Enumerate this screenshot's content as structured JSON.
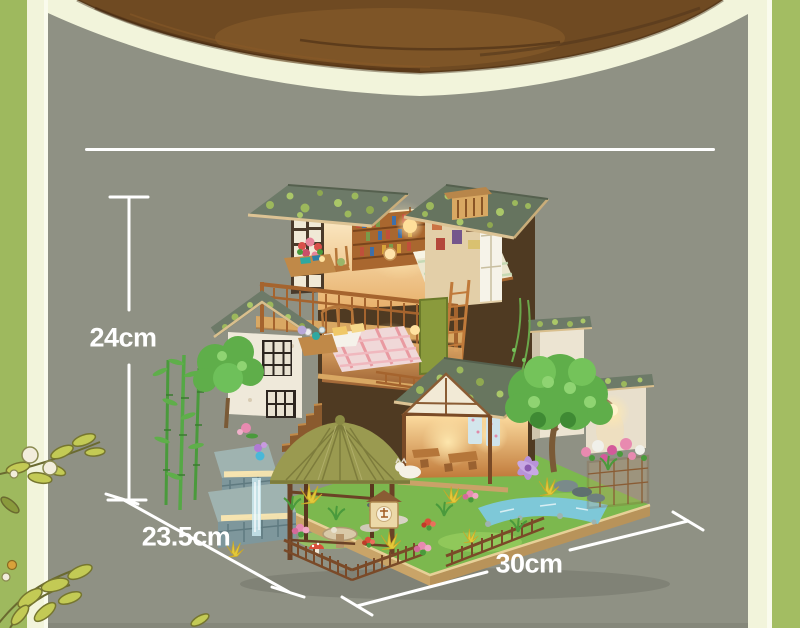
{
  "frame": {
    "left_bar_color": "#9eb95e",
    "right_bar_color": "#a3bd62",
    "mat_color": "#f2f4db",
    "backdrop_color": "#8f9184",
    "divider_line_color": "#ffffff"
  },
  "table_edge": {
    "wood_color": "#6f4a22"
  },
  "dimensions": {
    "line_color": "#ffffff",
    "height_label": "24cm",
    "depth_label": "23.5cm",
    "width_label": "30cm"
  }
}
